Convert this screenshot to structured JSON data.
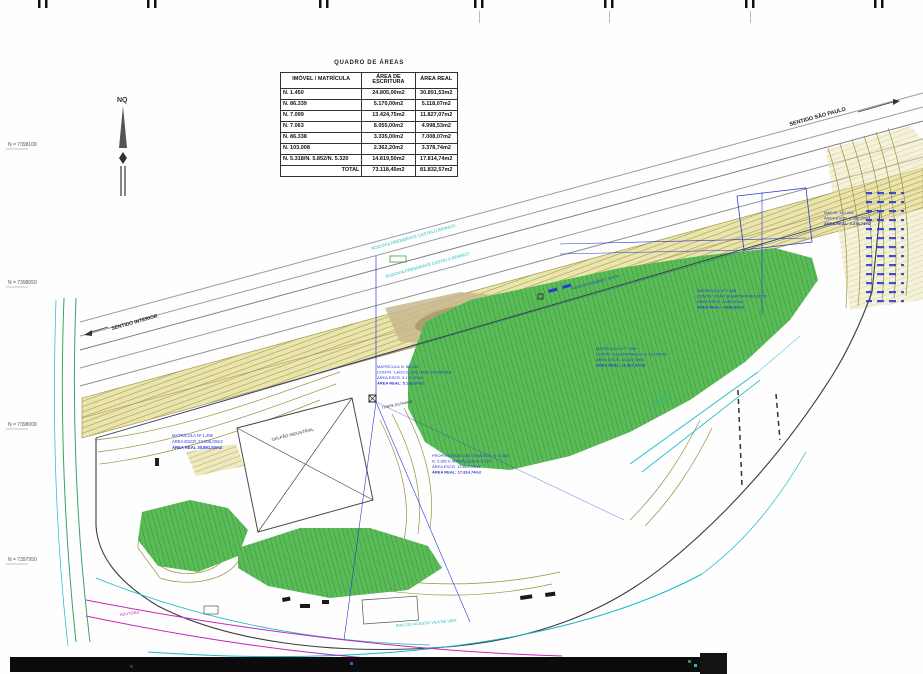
{
  "table": {
    "title": "QUADRO DE ÁREAS",
    "columns": [
      "IMÓVEL / MATRÍCULA",
      "ÁREA DE ESCRITURA",
      "ÁREA REAL"
    ],
    "rows": [
      [
        "N. 1.450",
        "24.805,00m2",
        "30.891,53m2"
      ],
      [
        "N. 86.339",
        "5.170,00m2",
        "5.118,07m2"
      ],
      [
        "N. 7.099",
        "13.424,75m2",
        "11.827,07m2"
      ],
      [
        "N. 7.063",
        "8.055,00m2",
        "4.998,53m2"
      ],
      [
        "N. 86.338",
        "3.335,00m2",
        "7.008,07m2"
      ],
      [
        "N. 103.008",
        "2.362,20m2",
        "3.378,74m2"
      ],
      [
        "N. 5.318/N. 5.852/N. 5.320",
        "14.819,50m2",
        "17.814,74m2"
      ]
    ],
    "total_label": "TOTAL",
    "total": [
      "73.118,45m2",
      "81.832,57m2"
    ]
  },
  "north": {
    "label": "NQ"
  },
  "grid": {
    "n_labels": [
      "N = 7398100",
      "N = 7398050",
      "N = 7398000",
      "N = 7397950"
    ]
  },
  "map": {
    "labels": {
      "sentido_sp": "SENTIDO SÃO PAULO",
      "sentido_interior": "SENTIDO INTERIOR",
      "rodovia_1": "RODOVIA PRESIDENTE CASTELO BRANCO",
      "rodovia_2": "RODOVIA PRESIDENTE CASTELO BRANCO",
      "faixa_dominio": "FAIXA DE DOMÍNIO - D.E.R.",
      "galpao": "GALPÃO INDUSTRIAL",
      "torre": "TORRE ESTAIADA",
      "corrego": "CÓRREGO",
      "adutora": "ADUTORA",
      "acesso": "EIXO DO ACESSO VILA DE VIDA"
    },
    "blocks": {
      "mat_1450": [
        "MATRÍCULA Nº 1.450",
        "ÁREA ESCR. 24.805,00m2",
        "ÁREA REAL 30.891,53m2"
      ],
      "mat_86339": [
        "MATRÍCULA N. 86.339",
        "CONTR. 'LAGO ELIAS / MAT. DIVERSAS'",
        "ÁREA ESCR. 5.170,00m2",
        "ÁREA REAL: 5.118,07m2"
      ],
      "mat_7063": [
        "MATRÍCULA Nº 7.063",
        "CONTR. 'JOÃO GUARITA RIVELATTO'",
        "ÁREA ESCR. 8.055,00m2",
        "ÁREA REAL: 4.998,53m2"
      ],
      "mat_7099": [
        "MATRÍCULA N.º 7.099",
        "CONTR. 'ELETROPAULO' E 'OUTROS'",
        "ÁREA ESCR. 13.424,75m2",
        "ÁREA REAL: 11.827,07m2"
      ],
      "mat_5318": [
        "PROPRIEDADE DAS TRANSCR. N. 5.318,",
        "N. 5.852 E MATRÍCULA N. 5.320",
        "ÁREA ESCR. 14.819,50m2",
        "ÁREA REAL: 17.814,74m2"
      ],
      "mat_103008": [
        "MAT. N. 103.008",
        "ÁREA ESCR. 2.362,20m2",
        "ÁREA REAL: 3.378,74m2"
      ]
    }
  },
  "colors": {
    "annotation_blue": "#2a3bd0",
    "hydro_cyan": "#1ab8c8",
    "pipeline_magenta": "#c827b8",
    "vegetation_green": "#5abb58",
    "contour_olive": "#a89c48",
    "linework_black": "#3c3c3c",
    "road_gray": "#9a9a9a"
  }
}
